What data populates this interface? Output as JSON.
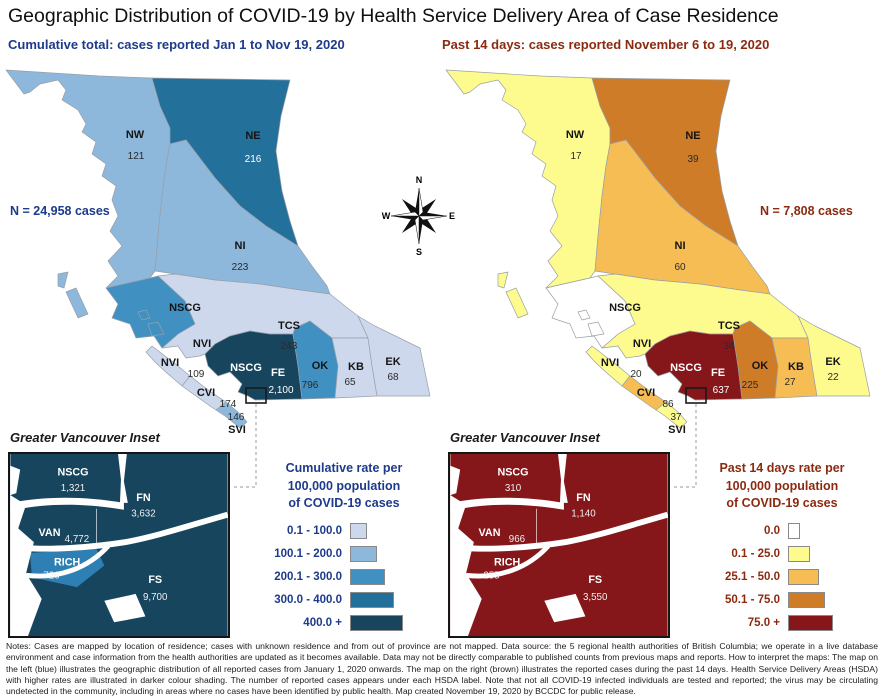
{
  "title": "Geographic Distribution of COVID-19 by Health Service Delivery Area of Case Residence",
  "compass": {
    "n": "N",
    "e": "E",
    "s": "S",
    "w": "W"
  },
  "palette": {
    "blue": {
      "l1": "#cdd8ed",
      "l2": "#8db7db",
      "l3": "#4190c2",
      "l4": "#23709b",
      "l5": "#17455e",
      "rich": "#2e80b4",
      "text": "#1d3a8c"
    },
    "brown": {
      "r0": "#ffffff",
      "r1": "#fdfb8d",
      "r2": "#f6bd55",
      "r3": "#cf7c28",
      "r4": "#851619",
      "rich": "#851619",
      "text": "#8c2a10"
    }
  },
  "left": {
    "subtitle": "Cumulative total: cases reported Jan 1 to Nov 19, 2020",
    "n_total": "N = 24,958 cases",
    "regions": {
      "nw": {
        "code": "NW",
        "value": "121"
      },
      "ne": {
        "code": "NE",
        "value": "216"
      },
      "ni": {
        "code": "NI",
        "value": "223"
      },
      "nscg_coastal": {
        "code": "NSCG"
      },
      "tcs": {
        "code": "TCS",
        "value": "243"
      },
      "nvi_mainland": {
        "code": "NVI"
      },
      "nvi": {
        "code": "NVI",
        "value": "109"
      },
      "cvi": {
        "code": "CVI",
        "value": "174"
      },
      "svi": {
        "code": "SVI",
        "value": "146"
      },
      "nscg": {
        "code": "NSCG"
      },
      "fe": {
        "code": "FE",
        "value": "2,100"
      },
      "ok": {
        "code": "OK",
        "value": "796"
      },
      "kb": {
        "code": "KB",
        "value": "65"
      },
      "ek": {
        "code": "EK",
        "value": "68"
      }
    },
    "inset": {
      "title": "Greater Vancouver Inset",
      "regions": {
        "nscg": {
          "code": "NSCG",
          "value": "1,321"
        },
        "fn": {
          "code": "FN",
          "value": "3,632"
        },
        "van": {
          "code": "VAN",
          "value": "4,772"
        },
        "rich": {
          "code": "RICH",
          "value": "726"
        },
        "fs": {
          "code": "FS",
          "value": "9,700"
        }
      }
    },
    "legend": {
      "title_lines": [
        "Cumulative rate per",
        "100,000 population",
        "of COVID-19 cases"
      ],
      "items": [
        {
          "label": "0.1 - 100.0"
        },
        {
          "label": "100.1 - 200.0"
        },
        {
          "label": "200.1 - 300.0"
        },
        {
          "label": "300.0 - 400.0"
        },
        {
          "label": "400.0 +"
        }
      ]
    }
  },
  "right": {
    "subtitle": "Past 14 days: cases reported November 6 to 19, 2020",
    "n_total": "N = 7,808 cases",
    "regions": {
      "nw": {
        "code": "NW",
        "value": "17"
      },
      "ne": {
        "code": "NE",
        "value": "39"
      },
      "ni": {
        "code": "NI",
        "value": "60"
      },
      "nscg_coastal": {
        "code": "NSCG"
      },
      "tcs": {
        "code": "TCS",
        "value": "34"
      },
      "nvi_mainland": {
        "code": "NVI"
      },
      "nvi": {
        "code": "NVI",
        "value": "20"
      },
      "cvi": {
        "code": "CVI",
        "value": "86"
      },
      "svi": {
        "code": "SVI",
        "value": "37"
      },
      "nscg": {
        "code": "NSCG"
      },
      "fe": {
        "code": "FE",
        "value": "637"
      },
      "ok": {
        "code": "OK",
        "value": "225"
      },
      "kb": {
        "code": "KB",
        "value": "27"
      },
      "ek": {
        "code": "EK",
        "value": "22"
      }
    },
    "inset": {
      "title": "Greater Vancouver Inset",
      "regions": {
        "nscg": {
          "code": "NSCG",
          "value": "310"
        },
        "fn": {
          "code": "FN",
          "value": "1,140"
        },
        "van": {
          "code": "VAN",
          "value": "966"
        },
        "rich": {
          "code": "RICH",
          "value": "255"
        },
        "fs": {
          "code": "FS",
          "value": "3,550"
        }
      }
    },
    "legend": {
      "title_lines": [
        "Past 14 days rate per",
        "100,000 population",
        "of COVID-19 cases"
      ],
      "items": [
        {
          "label": "0.0"
        },
        {
          "label": "0.1 - 25.0"
        },
        {
          "label": "25.1 - 50.0"
        },
        {
          "label": "50.1 - 75.0"
        },
        {
          "label": "75.0 +"
        }
      ]
    }
  },
  "notes": "Notes: Cases are mapped by location of residence; cases with unknown residence and from out of province are not mapped. Data source: the 5 regional health authorities of British Columbia; we operate in a live database environment and case information from the health authorities are updated as it becomes available. Data may not be directly comparable to published counts from previous maps and reports. How to interpret the maps: The map on the left (blue) illustrates the geographic distribution of all reported cases from January 1, 2020 onwards. The map on the right (brown) illustrates the reported cases during the past 14 days. Health Service Delivery Areas (HSDA) with higher rates are illustrated in darker colour shading. The number of reported cases appears under each HSDA label. Note that not all COVID-19 infected individuals are tested and reported; the virus may be circulating undetected in the community, including in areas where no cases have been identified by public health. Map created November 19, 2020 by BCCDC for public release."
}
